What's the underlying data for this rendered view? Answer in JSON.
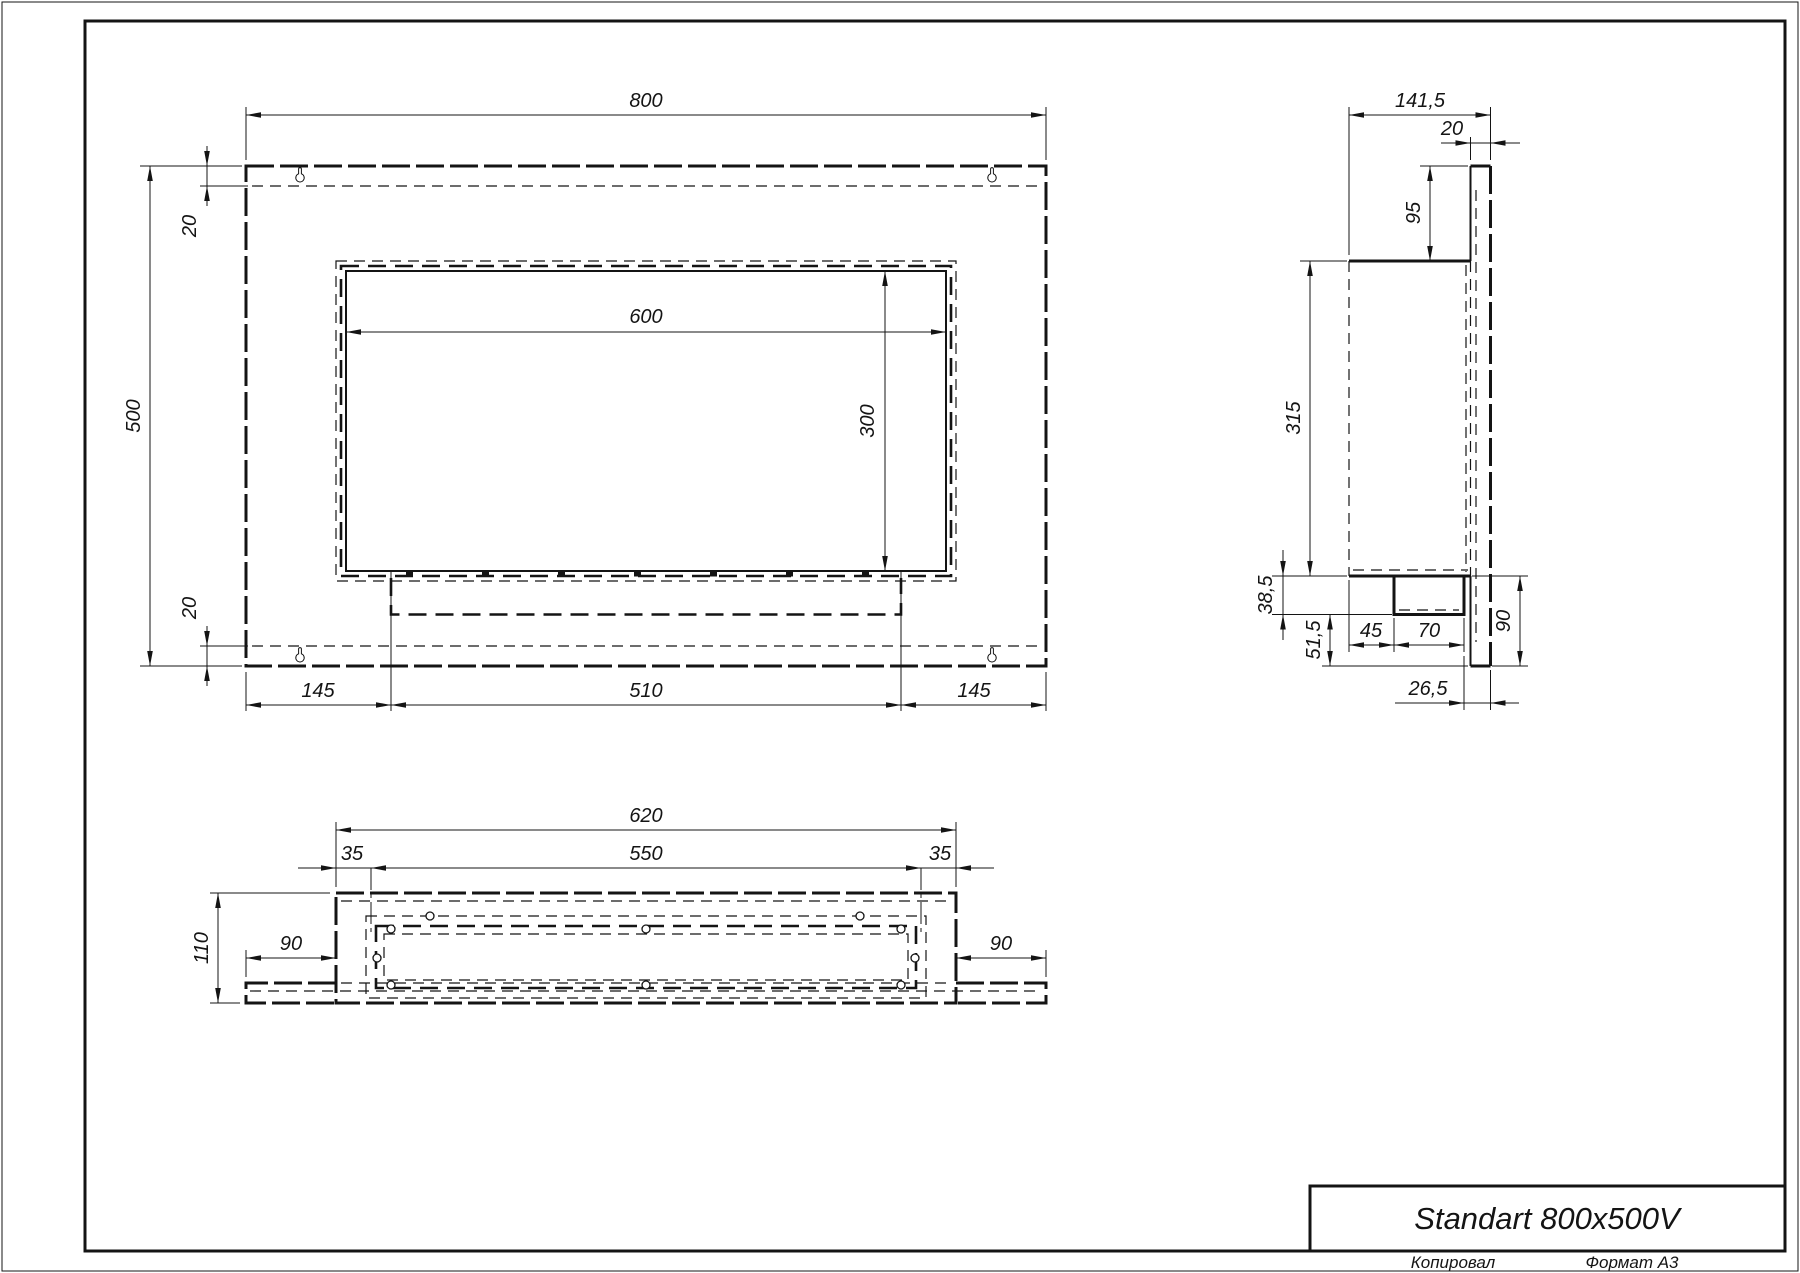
{
  "page": {
    "background": "#ffffff",
    "line_color": "#141414"
  },
  "title_block": {
    "product_title": "Standart 800x500V"
  },
  "footer": {
    "copied_by_label": "Копировал",
    "format_label": "Формат А3"
  },
  "views": {
    "front": {
      "dims": {
        "overall_width": "800",
        "overall_height": "500",
        "top_fold": "20",
        "bottom_fold": "20",
        "opening_width": "600",
        "opening_height": "300",
        "left_offset": "145",
        "tray_width": "510",
        "right_offset": "145"
      }
    },
    "side": {
      "dims": {
        "overall_depth": "141,5",
        "panel_thickness": "20",
        "top_offset": "95",
        "body_height": "315",
        "tray_drop": "38,5",
        "bottom_clearance": "51,5",
        "tray_front_offset": "45",
        "tray_depth": "70",
        "tray_rear_gap": "26,5",
        "panel_bottom_extension": "90"
      }
    },
    "bottom": {
      "dims": {
        "body_width": "620",
        "tray_width": "550",
        "tray_margin_left": "35",
        "tray_margin_right": "35",
        "body_depth": "110",
        "flange_left": "90",
        "flange_right": "90"
      }
    }
  }
}
